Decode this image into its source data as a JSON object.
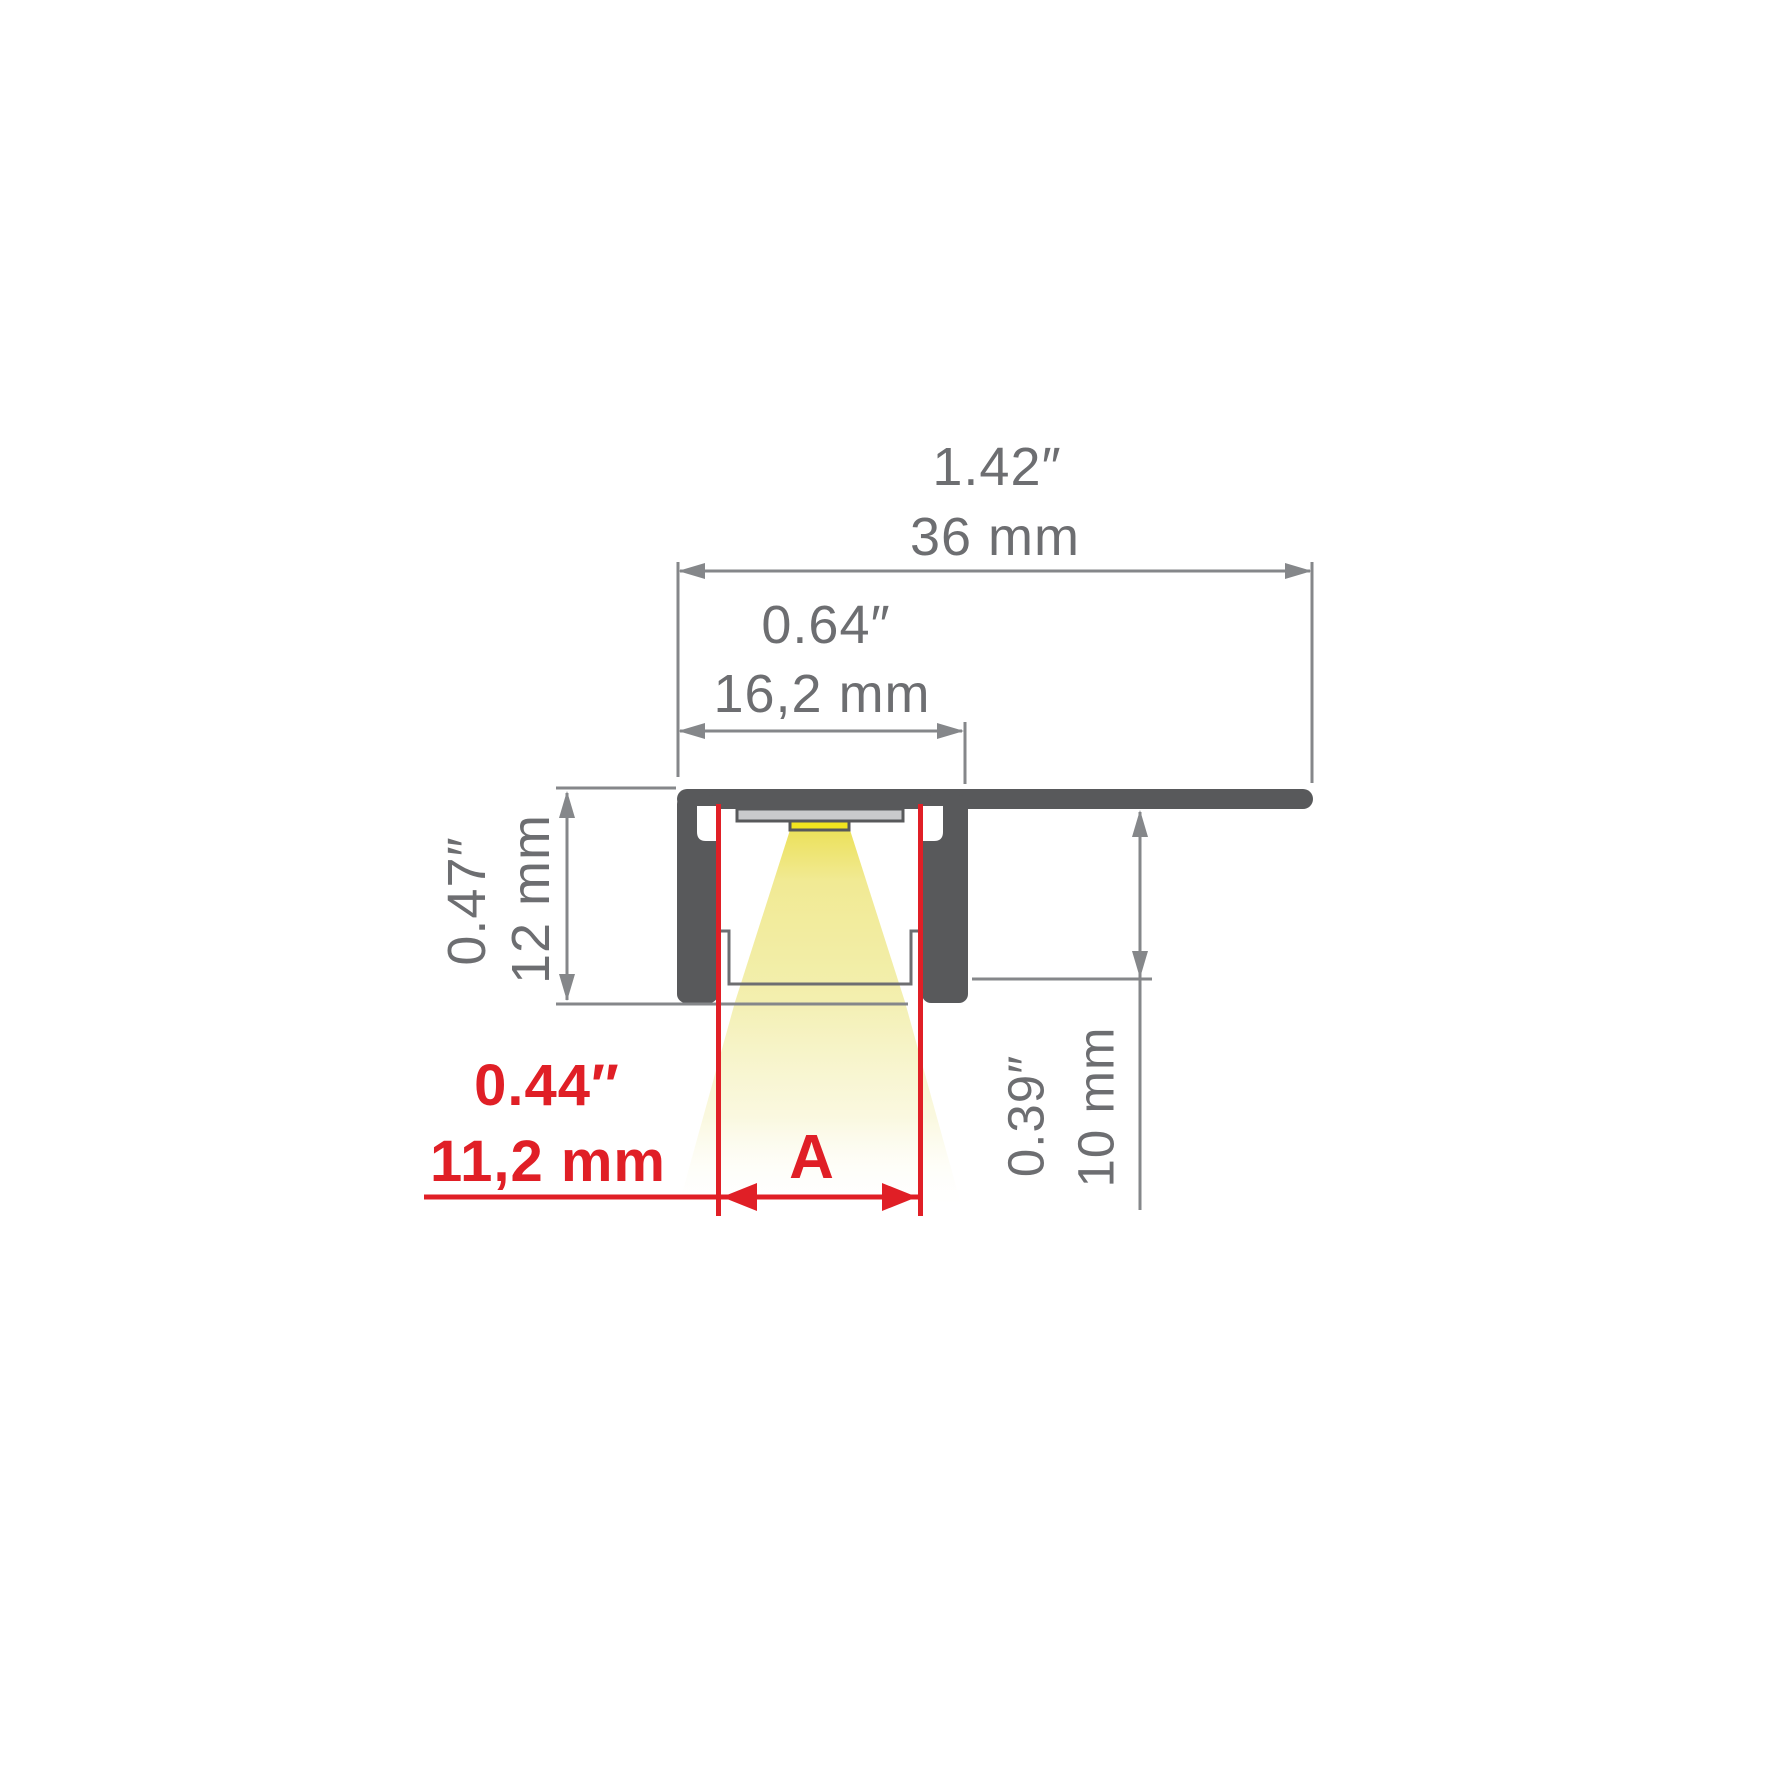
{
  "figure": {
    "type": "technical-dimension-drawing",
    "subject": "recessed LED aluminium profile cross-section with LED strip and light beam"
  },
  "dims": {
    "overall": {
      "inches": "1.42″",
      "mm": "36 mm"
    },
    "inner": {
      "inches": "0.64″",
      "mm": "16,2 mm"
    },
    "height": {
      "inches": "0.47″",
      "mm": "12 mm"
    },
    "offset": {
      "inches": "0.39″",
      "mm": "10 mm"
    },
    "opening": {
      "inches": "0.44″",
      "mm": "11,2 mm",
      "label": "A"
    }
  },
  "colors": {
    "profile_body": "#58595B",
    "dimension_lines": "#85878A",
    "dimension_text": "#6D6E71",
    "accent_red": "#E01F26",
    "led_yellow": "#F2E41F",
    "beam_yellow": "#F3EFAF",
    "pcb_gray": "#C9CACC",
    "background": "#FFFFFF"
  }
}
